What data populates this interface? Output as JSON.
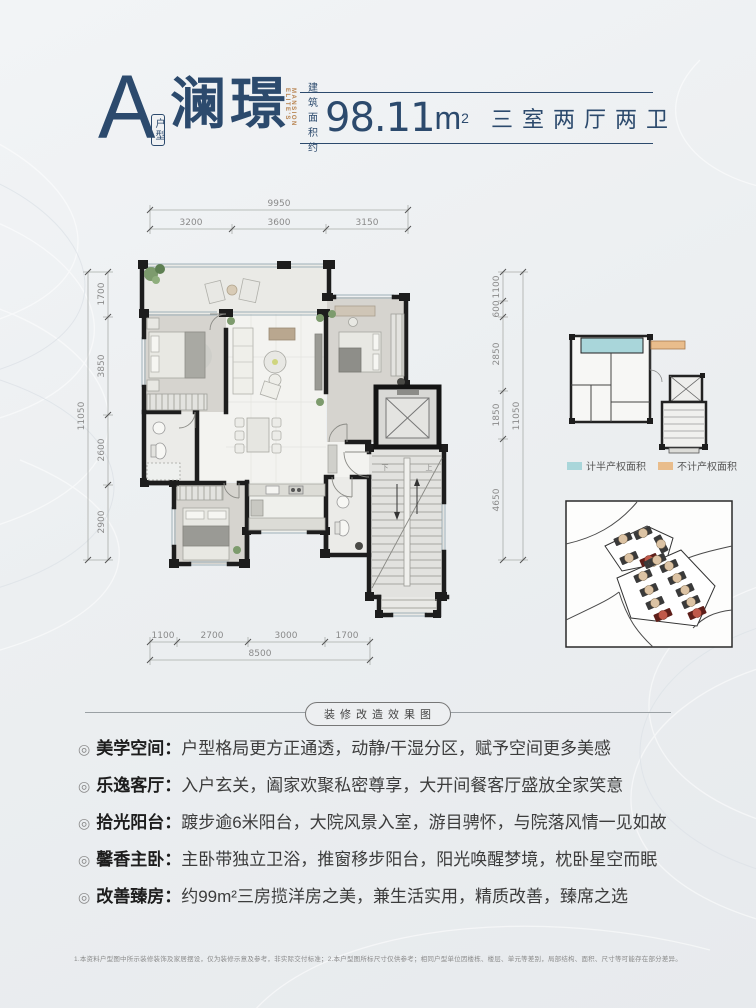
{
  "colors": {
    "navy": "#2c4a6d",
    "accent_en": "#b8834f",
    "highlight_red": "#8f2b22"
  },
  "header": {
    "unit_letter": "A",
    "unit_type": "户型",
    "name": "澜璟",
    "name_en": "ELITE'S MANSION",
    "area_label_1": "建 筑",
    "area_label_2": "面积约",
    "area_value": "98.11",
    "area_unit": "m",
    "area_sup": "2",
    "rooms": "三室两厅两卫"
  },
  "dims": {
    "top_total": "9950",
    "top": [
      "3200",
      "3600",
      "3150"
    ],
    "left_total": "11050",
    "left": [
      "1700",
      "3850",
      "2600",
      "2900"
    ],
    "right_total": "11050",
    "right": [
      "1100",
      "600",
      "2850",
      "1850",
      "4650"
    ],
    "bottom_total": "8500",
    "bottom": [
      "1100",
      "2700",
      "3000",
      "1700"
    ]
  },
  "floorplan": {
    "stair_down": "下",
    "stair_up": "上"
  },
  "keyplan": {
    "legend": [
      {
        "label": "计半产权面积",
        "color": "#a9d6da"
      },
      {
        "label": "不计产权面积",
        "color": "#e9bd8c"
      }
    ]
  },
  "divider_label": "装修改造效果图",
  "bullet_glyph": "◎",
  "features": [
    {
      "title": "美学空间",
      "colon": "：",
      "desc": "户型格局更方正通透，动静/干湿分区，赋予空间更多美感"
    },
    {
      "title": "乐逸客厅",
      "colon": "：",
      "desc": "入户玄关，阖家欢聚私密尊享，大开间餐客厅盛放全家笑意"
    },
    {
      "title": "拾光阳台",
      "colon": "：",
      "desc": "踱步逾6米阳台，大院风景入室，游目骋怀，与院落风情一见如故"
    },
    {
      "title": "馨香主卧",
      "colon": "：",
      "desc": "主卧带独立卫浴，推窗移步阳台，阳光唤醒梦境，枕卧星空而眠"
    },
    {
      "title": "改善臻房",
      "colon": "：",
      "desc": "约99m²三房揽洋房之美，兼生活实用，精质改善，臻席之选"
    }
  ],
  "footnote": "1.本资料户型图中所示装修装饰及家居摆设，仅为装修示意及参考，非实际交付标准；2.本户型图所标尺寸仅供参考；相同户型单位因楼栋、楼层、单元等差别，局部结构、面积、尺寸等可能存在部分差异。"
}
